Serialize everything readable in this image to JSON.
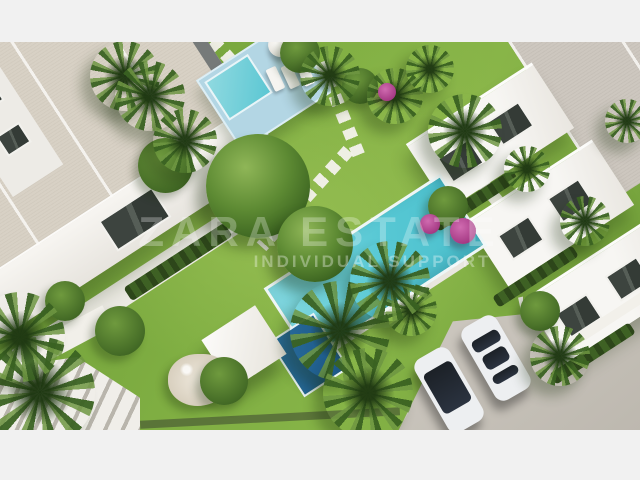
{
  "scene": {
    "description": "Aerial 3D architectural rendering of a white residential complex with two communal swimming pools, sun deck, pergola, lawns, palm trees, stepping-stone paths, rock garden and a parking area with two cars",
    "frame_color": "#f1f1f1"
  },
  "watermark": {
    "line1": "ZARA ESTATE",
    "line2": "INDIVIDUAL SUPPORT"
  },
  "palette": {
    "grass": "#7aa73e",
    "grass_light": "#9ac155",
    "pool_water": "#5fccd7",
    "pool_deep": "#1f5e8d",
    "deck_blue": "#b3d6e4",
    "roof_left_beige": "#d8d1c5",
    "roof_right_gray": "#cdc7bf",
    "walls_white": "#f3f1ec",
    "paving_gray": "#c8c3bb",
    "hedge_green": "#3e6124",
    "palm_green": "#4f7d2e",
    "bougainvillea": "#b14a92",
    "car_body": "#edeff1",
    "car_glass": "#20262e"
  }
}
